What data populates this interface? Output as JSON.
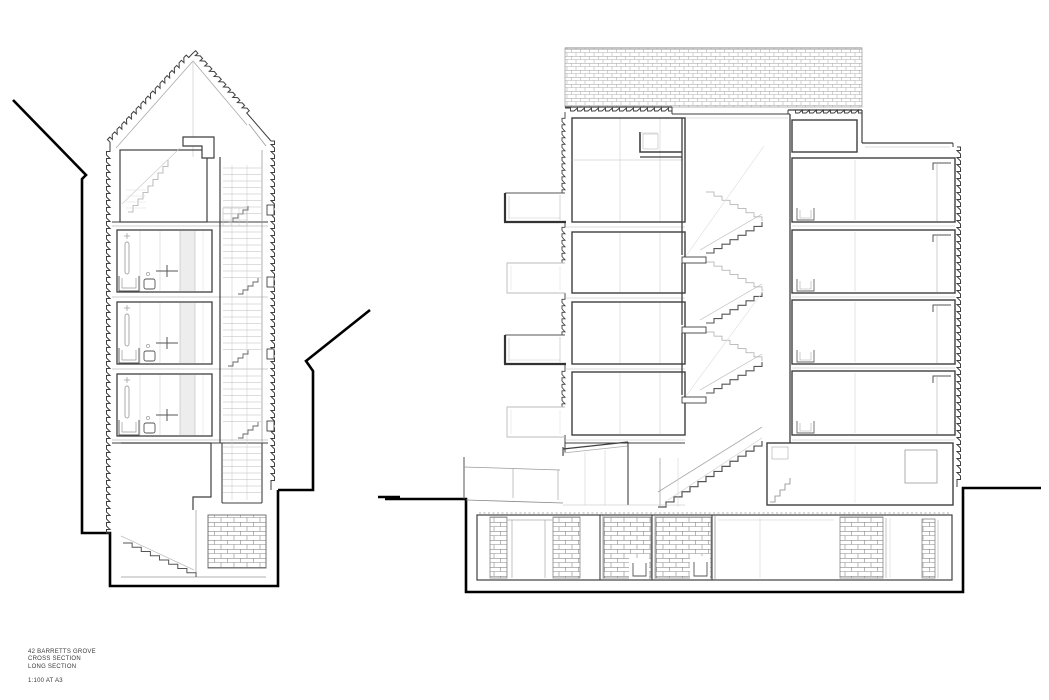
{
  "title_block": {
    "project": "42 BARRETTS GROVE",
    "drawing1": "CROSS SECTION",
    "drawing2": "LONG SECTION",
    "scale": "1:100 AT A3"
  },
  "drawings": {
    "cross_section": {
      "label": "CROSS SECTION"
    },
    "long_section": {
      "label": "LONG SECTION"
    }
  },
  "colors": {
    "background": "#ffffff",
    "site_line": "#000000",
    "cut_line": "#3f3f3f",
    "medium_line": "#666666",
    "light_line": "#aaaaaa",
    "faint_line": "#cccccc",
    "hatch_line": "#999999",
    "band_fill": "#ededed"
  }
}
